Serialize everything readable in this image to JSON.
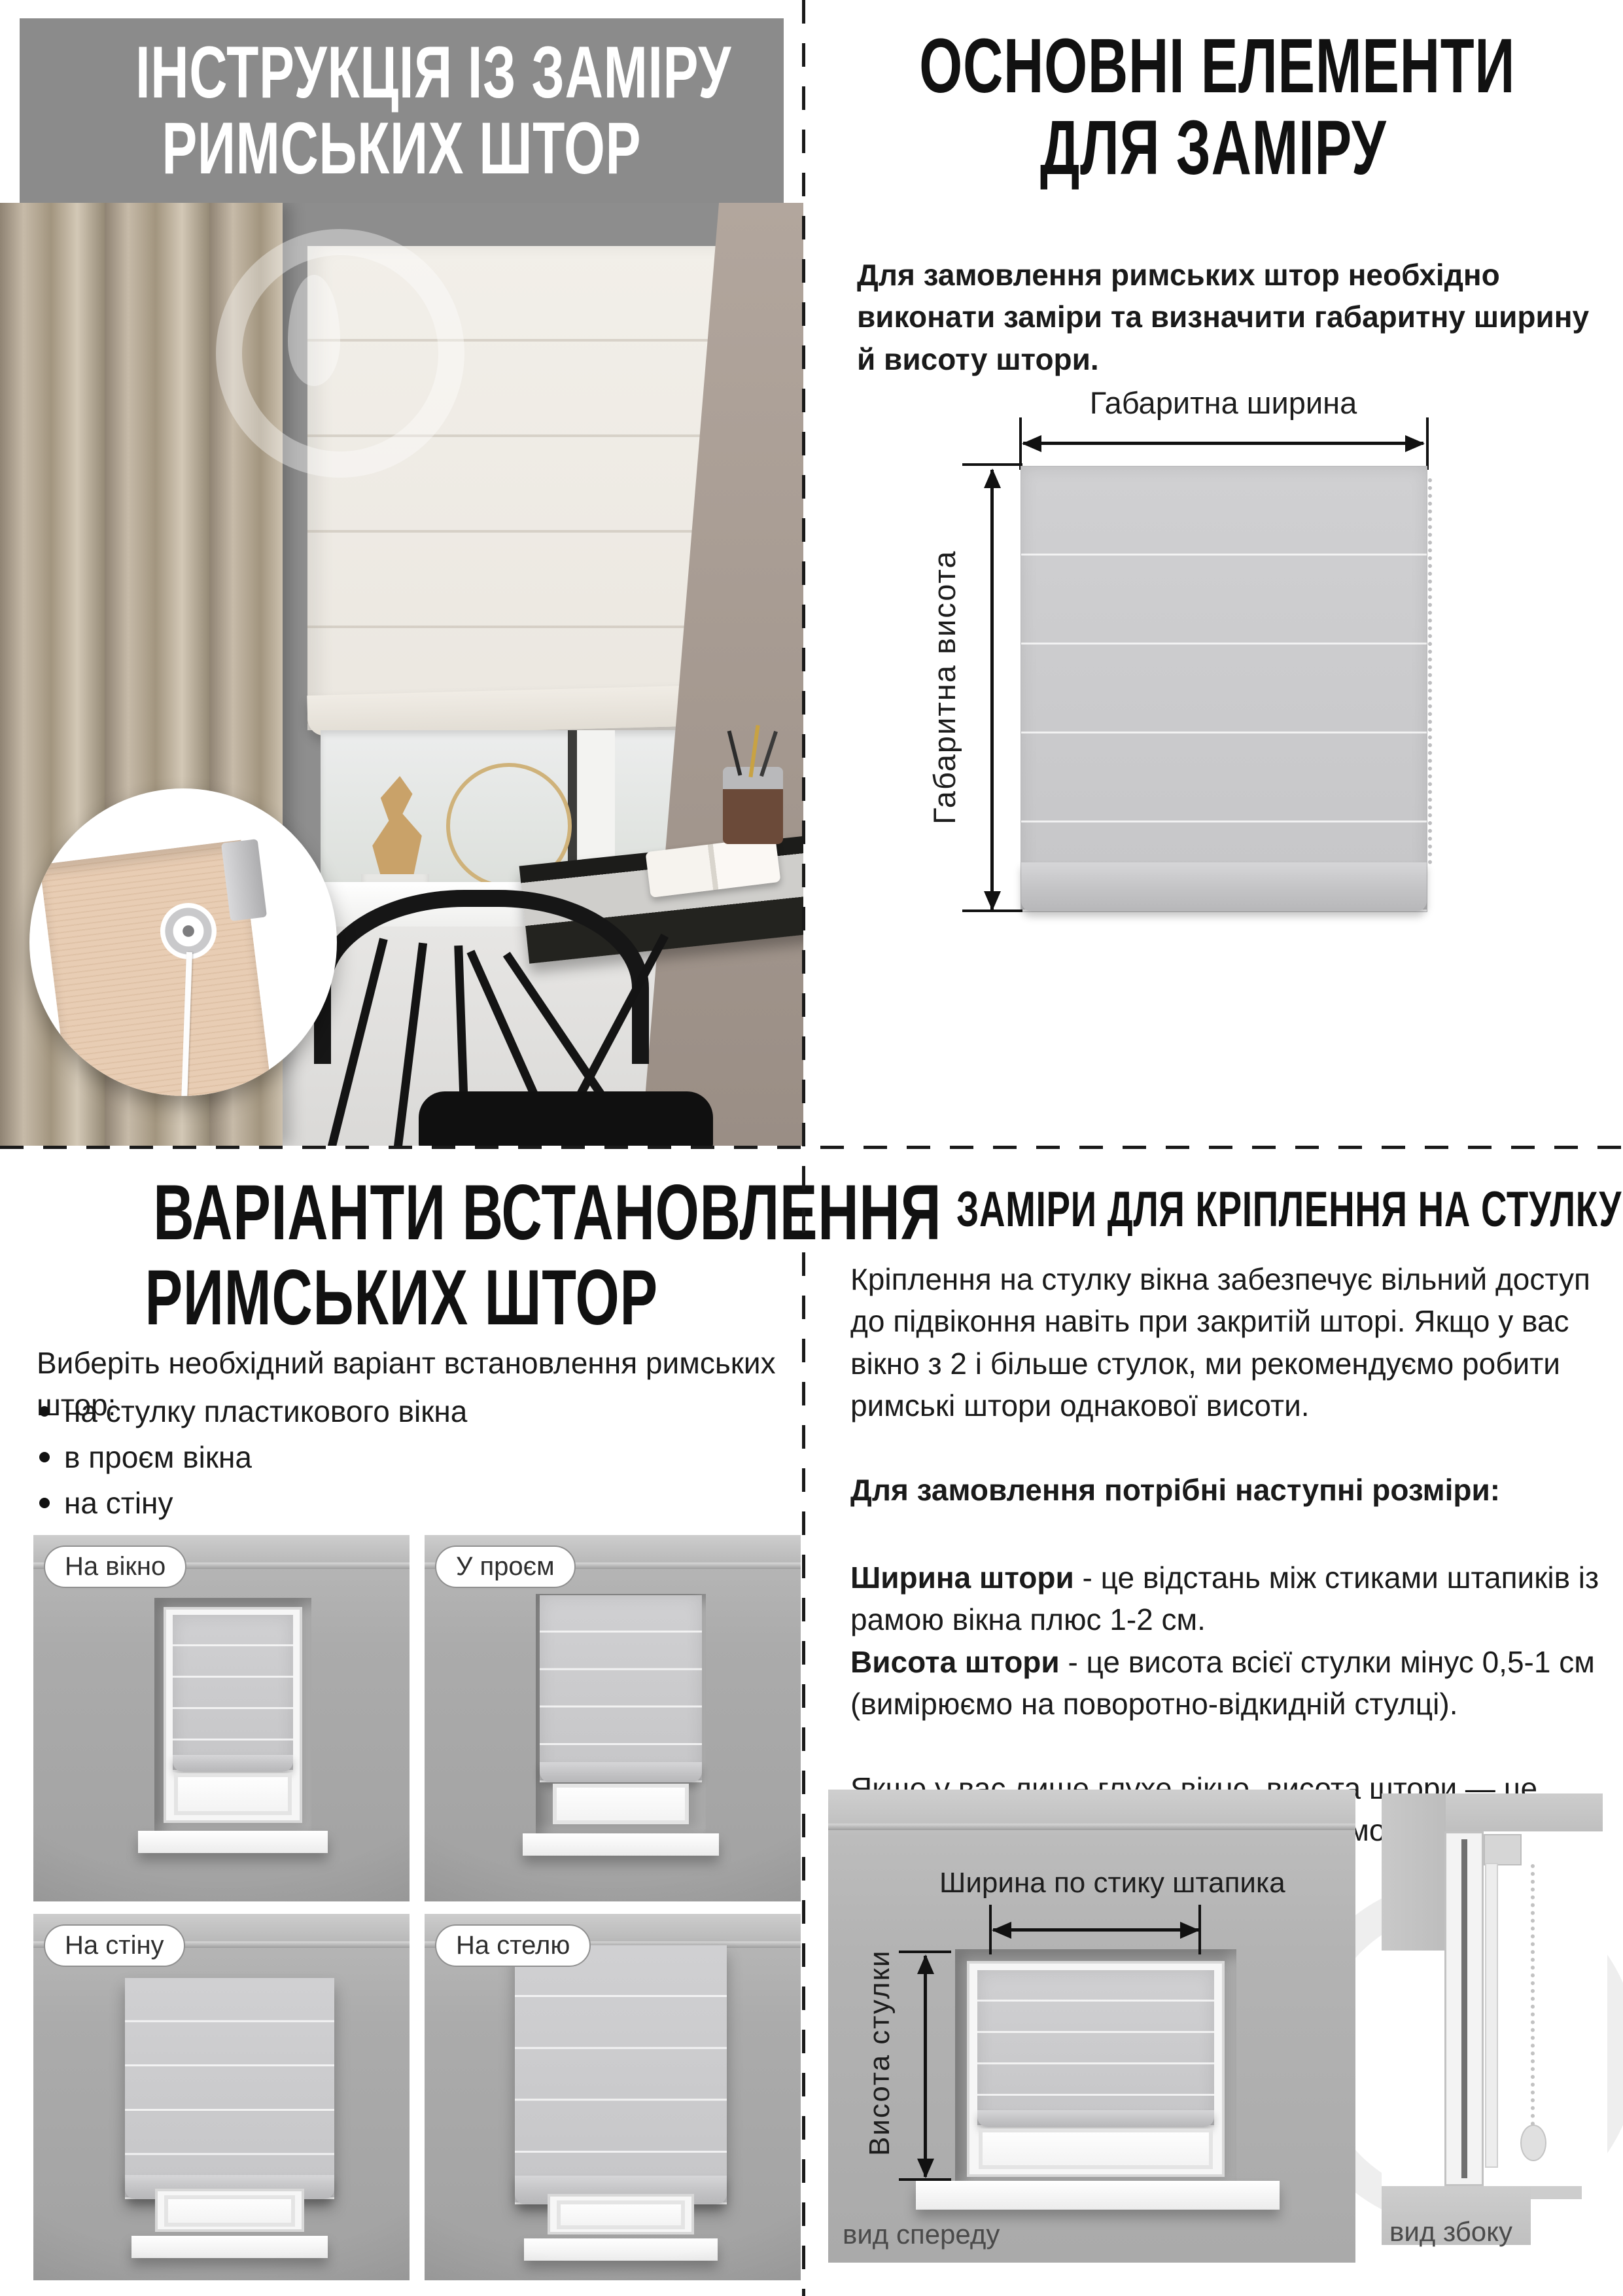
{
  "top_left": {
    "header": {
      "line1": "ІНСТРУКЦІЯ ІЗ ЗАМІРУ",
      "line2": "РИМСЬКИХ ШТОР",
      "bg": "#8b8b8b",
      "color": "#ffffff"
    }
  },
  "top_right": {
    "title_line1": "ОСНОВНІ ЕЛЕМЕНТИ",
    "title_line2": "ДЛЯ ЗАМІРУ",
    "intro": "Для замовлення римських штор необхідно виконати заміри та визначити габаритну ширину й висоту штори.",
    "diagram": {
      "width_label": "Габаритна ширина",
      "height_label": "Габаритна висота"
    }
  },
  "bottom_left": {
    "title_line1": "ВАРІАНТИ ВСТАНОВЛЕННЯ",
    "title_line2": "РИМСЬКИХ ШТОР",
    "subtitle": "Виберіть необхідний варіант встановлення римських штор:",
    "bullets": [
      "на стулку пластикового вікна",
      "в проєм вікна",
      "на стіну",
      "на стелю"
    ],
    "options": [
      {
        "label": "На вікно"
      },
      {
        "label": "У проєм"
      },
      {
        "label": "На стіну"
      },
      {
        "label": "На стелю"
      }
    ]
  },
  "bottom_right": {
    "title": "ЗАМІРИ ДЛЯ КРІПЛЕННЯ НА СТУЛКУ ВІКНА",
    "p1": "Кріплення на стулку вікна забезпечує вільний доступ до підвіконня навіть при закритій шторі. Якщо у вас вікно з 2 і більше стулок, ми рекомендуємо робити римські штори однакової висоти.",
    "p2_bold": "Для замовлення потрібні наступні розміри:",
    "def1_term": "Ширина штори",
    "def1_text": " - це відстань між стиками штапиків із рамою вікна плюс 1-2 см.",
    "def2_term": "Висота штори",
    "def2_text": " - це висота всієї стулки мінус 0,5-1 см (вимірюємо на поворотно-відкидній стулці).",
    "p3": "Якщо у вас лише глухе вікно, висота штори — це відстань між стиками штапиків із рамою вікна (плюс 1-3 см).",
    "diagram": {
      "width_label": "Ширина по стику штапика",
      "height_label": "Висота стулки",
      "front_label": "вид спереду",
      "side_label": "вид збоку"
    }
  },
  "colors": {
    "banner_bg": "#8b8b8b",
    "text": "#1a1a1a",
    "fabric": "#c9c9cb",
    "curtain": "#bdb1a0",
    "wall_photo": "#a39789"
  }
}
